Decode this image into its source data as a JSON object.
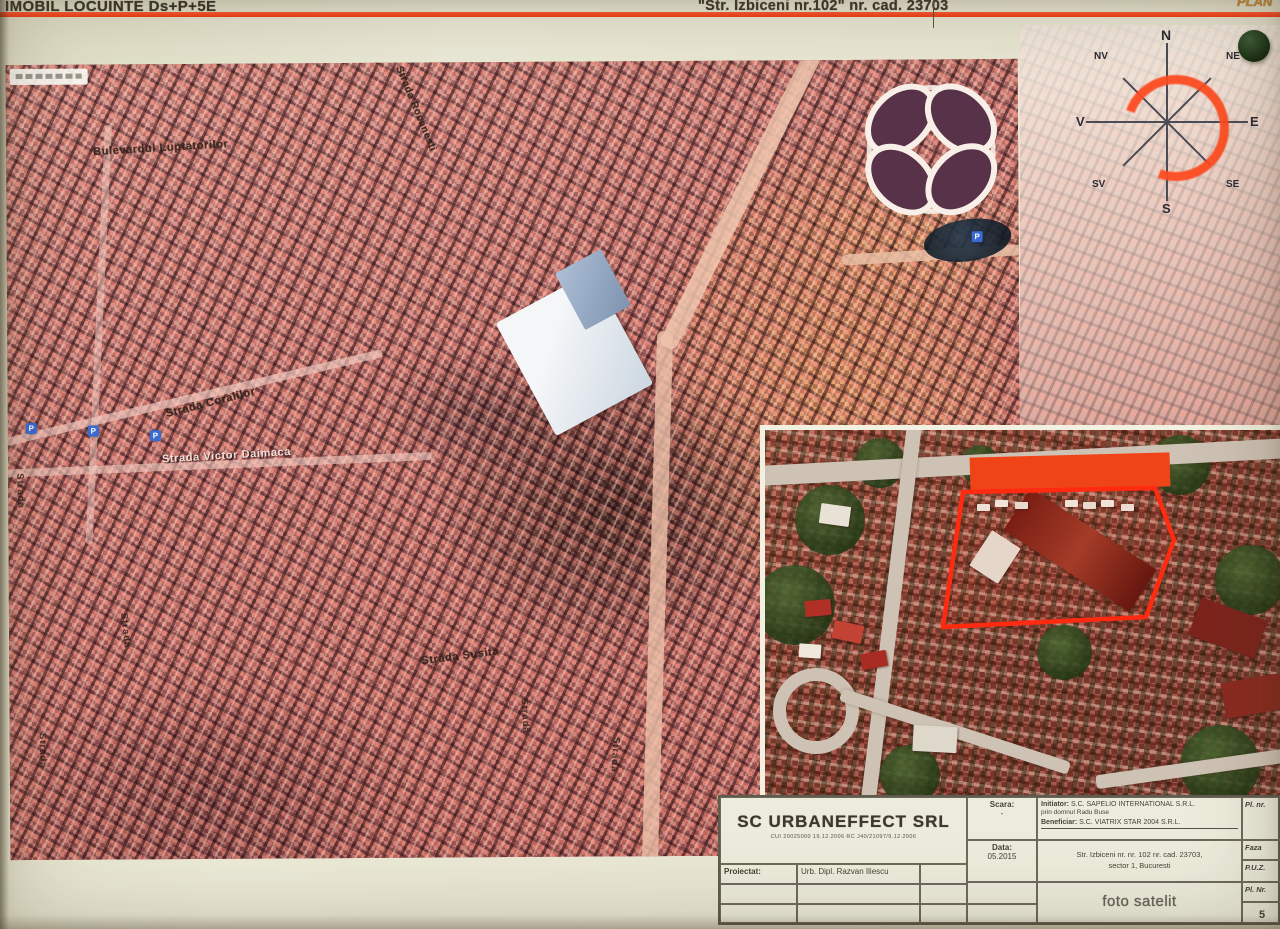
{
  "header": {
    "title_left": "IMOBIL LOCUINTE Ds+P+5E",
    "title_center": "\"Str. Izbiceni nr.102\" nr. cad. 23703",
    "corner_text": "PLAN"
  },
  "compass": {
    "n": "N",
    "ne": "NE",
    "e": "E",
    "se": "SE",
    "s": "S",
    "sv": "SV",
    "v": "V",
    "nv": "NV"
  },
  "map": {
    "labels": {
      "luptatorilor": "Bulevardul Luptatorilor",
      "rocanesti": "Strada Rocanesti",
      "coralilor": "Strada Coralilor",
      "daimaca": "Strada Victor Daimaca",
      "susita": "Strada Susita",
      "v1": "Strada",
      "v2": "Strada",
      "v3": "Strada",
      "v4": "Strada",
      "v5": "Strada"
    },
    "parking_label": "P"
  },
  "titleblock": {
    "company": "SC URBANEFFECT SRL",
    "company_reg": "CUI 20025000 19.12.2006  RC J40/21097/9.12.2006",
    "proiectat_label": "Proiectat:",
    "proiectat_value": "Urb. Dipl. Razvan Iliescu",
    "scara_label": "Scara:",
    "scara_value": "-",
    "data_label": "Data:",
    "data_value": "05.2015",
    "initiator_label": "Initiator:",
    "initiator_value": "S.C. SAPELIO INTERNATIONAL S.R.L.",
    "initiator_line2": "prin domnul Radu Buse",
    "beneficiar_label": "Beneficiar:",
    "beneficiar_value": "S.C. VIATRIX STAR 2004 S.R.L.",
    "address_line1": "Str. Izbiceni nr. nr. 102 nr. cad. 23703,",
    "address_line2": "sector 1, Bucuresti",
    "drawing_title": "foto satelit",
    "col_pl_nr": "Pl. nr.",
    "col_faza": "Faza",
    "col_puz": "P.U.Z.",
    "col_pl_nr2": "Pl. Nr.",
    "sheet_number": "5"
  },
  "colors": {
    "accent": "#ff4a22",
    "plot_outline": "#ff2a10",
    "redaction": "#ef4418"
  }
}
